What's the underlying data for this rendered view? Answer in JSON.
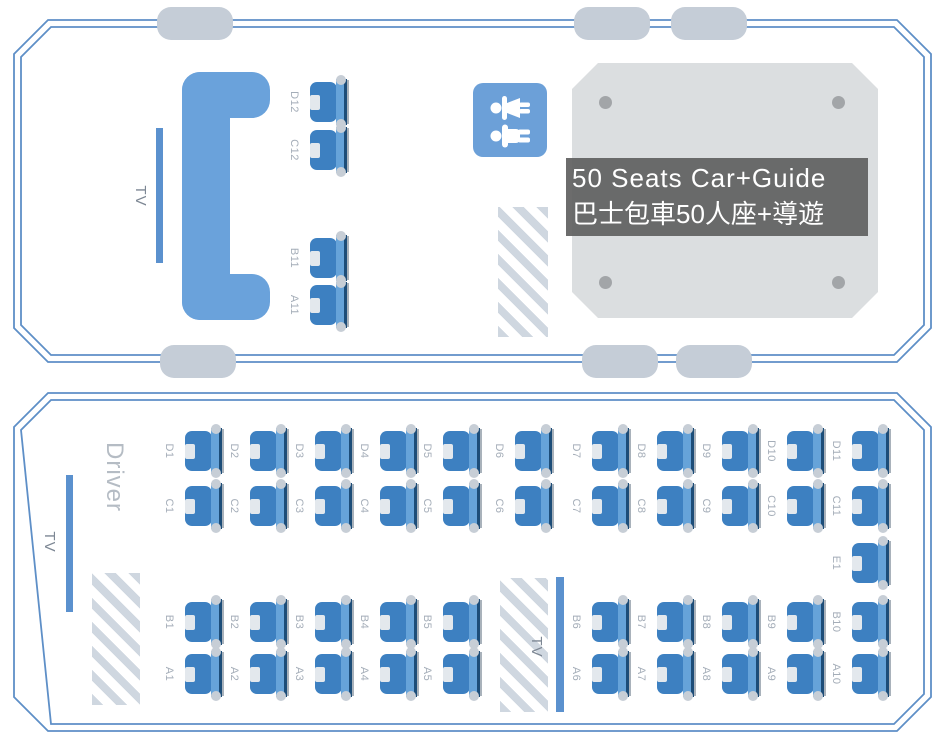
{
  "title_overlay": {
    "line1": "50 Seats Car+Guide",
    "line2": "巴士包車50人座+導遊"
  },
  "rear_section": {
    "tv_label": "TV",
    "seats": [
      {
        "id": "D12",
        "x": 310,
        "y": 79
      },
      {
        "id": "C12",
        "x": 310,
        "y": 127
      },
      {
        "id": "B11",
        "x": 310,
        "y": 235
      },
      {
        "id": "A11",
        "x": 310,
        "y": 282
      }
    ]
  },
  "main_section": {
    "driver_label": "Driver",
    "front_tv_label": "TV",
    "mid_tv_label": "TV",
    "seats": [
      {
        "id": "D1",
        "x": 185,
        "y": 428
      },
      {
        "id": "D2",
        "x": 250,
        "y": 428
      },
      {
        "id": "D3",
        "x": 315,
        "y": 428
      },
      {
        "id": "D4",
        "x": 380,
        "y": 428
      },
      {
        "id": "D5",
        "x": 443,
        "y": 428
      },
      {
        "id": "D6",
        "x": 515,
        "y": 428
      },
      {
        "id": "D7",
        "x": 592,
        "y": 428
      },
      {
        "id": "D8",
        "x": 657,
        "y": 428
      },
      {
        "id": "D9",
        "x": 722,
        "y": 428
      },
      {
        "id": "D10",
        "x": 787,
        "y": 428
      },
      {
        "id": "D11",
        "x": 852,
        "y": 428
      },
      {
        "id": "C1",
        "x": 185,
        "y": 483
      },
      {
        "id": "C2",
        "x": 250,
        "y": 483
      },
      {
        "id": "C3",
        "x": 315,
        "y": 483
      },
      {
        "id": "C4",
        "x": 380,
        "y": 483
      },
      {
        "id": "C5",
        "x": 443,
        "y": 483
      },
      {
        "id": "C6",
        "x": 515,
        "y": 483
      },
      {
        "id": "C7",
        "x": 592,
        "y": 483
      },
      {
        "id": "C8",
        "x": 657,
        "y": 483
      },
      {
        "id": "C9",
        "x": 722,
        "y": 483
      },
      {
        "id": "C10",
        "x": 787,
        "y": 483
      },
      {
        "id": "C11",
        "x": 852,
        "y": 483
      },
      {
        "id": "E1",
        "x": 852,
        "y": 540
      },
      {
        "id": "B1",
        "x": 185,
        "y": 599
      },
      {
        "id": "B2",
        "x": 250,
        "y": 599
      },
      {
        "id": "B3",
        "x": 315,
        "y": 599
      },
      {
        "id": "B4",
        "x": 380,
        "y": 599
      },
      {
        "id": "B5",
        "x": 443,
        "y": 599
      },
      {
        "id": "B6",
        "x": 592,
        "y": 599
      },
      {
        "id": "B7",
        "x": 657,
        "y": 599
      },
      {
        "id": "B8",
        "x": 722,
        "y": 599
      },
      {
        "id": "B9",
        "x": 787,
        "y": 599
      },
      {
        "id": "B10",
        "x": 852,
        "y": 599
      },
      {
        "id": "A1",
        "x": 185,
        "y": 651
      },
      {
        "id": "A2",
        "x": 250,
        "y": 651
      },
      {
        "id": "A3",
        "x": 315,
        "y": 651
      },
      {
        "id": "A4",
        "x": 380,
        "y": 651
      },
      {
        "id": "A5",
        "x": 443,
        "y": 651
      },
      {
        "id": "A6",
        "x": 592,
        "y": 651
      },
      {
        "id": "A7",
        "x": 657,
        "y": 651
      },
      {
        "id": "A8",
        "x": 722,
        "y": 651
      },
      {
        "id": "A9",
        "x": 787,
        "y": 651
      },
      {
        "id": "A10",
        "x": 852,
        "y": 651
      }
    ]
  },
  "colors": {
    "panel_border": "#5e8fc7",
    "seat_blue": "#3d80c1",
    "seat_back_blue": "#66a3d9",
    "bench_blue": "#6aa2db",
    "tv_bar_blue": "#5b91ce",
    "wheel_gray": "#c5cdd7",
    "hatch_gray": "#cfd7e0",
    "table_gray": "#dbdee0",
    "overlay_gray": "#606060",
    "label_gray": "#a4adb8"
  }
}
